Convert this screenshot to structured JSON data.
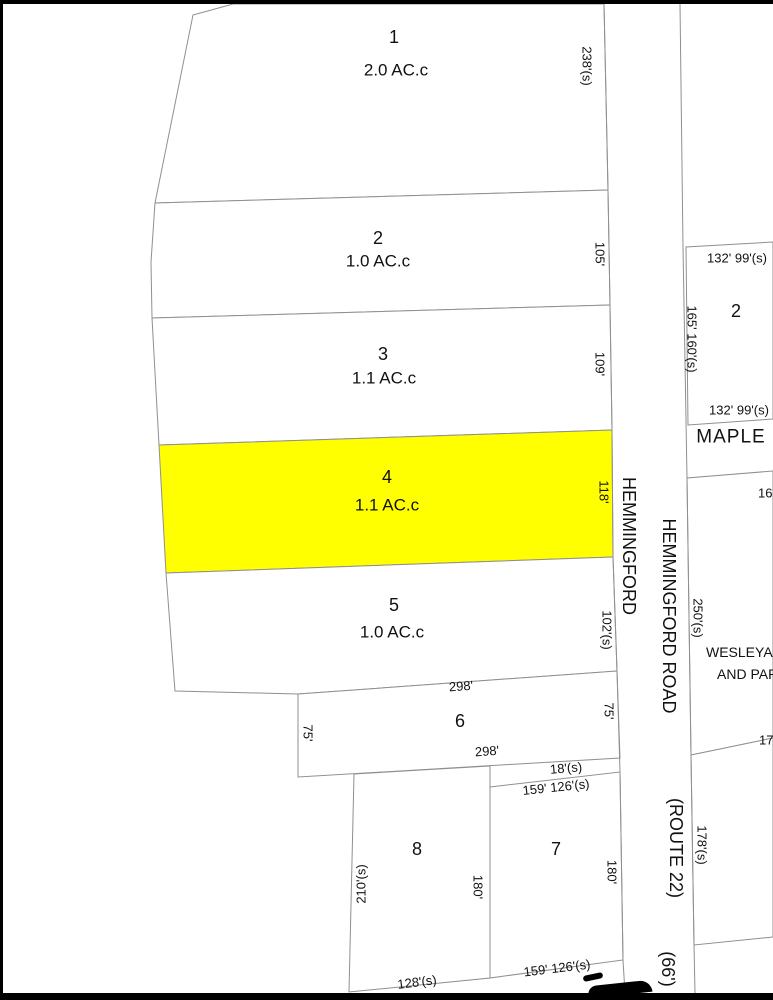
{
  "map": {
    "style": {
      "background": "#ffffff",
      "line_color": "#8f8f8f",
      "frame_color": "#000000",
      "text_color": "#111111",
      "highlight_fill": "#ffff00",
      "parcel_fill": "#ffffff"
    },
    "frame": [
      {
        "name": "frame-top",
        "x": 0,
        "y": 0,
        "w": 773,
        "h": 4
      },
      {
        "name": "frame-left",
        "x": 0,
        "y": 0,
        "w": 3,
        "h": 1000
      },
      {
        "name": "frame-bottom",
        "x": 0,
        "y": 993,
        "w": 773,
        "h": 7
      }
    ],
    "parcels": [
      {
        "name": "parcel-lot-1",
        "points": "233,4 604,4 608,190 155,203 193,15",
        "fill": "#ffffff"
      },
      {
        "name": "parcel-lot-2",
        "points": "155,203 608,190 610,305 152,318 151,262",
        "fill": "#ffffff"
      },
      {
        "name": "parcel-lot-3",
        "points": "152,318 610,305 612,430 159,445",
        "fill": "#ffffff"
      },
      {
        "name": "parcel-lot-4-highlighted",
        "points": "159,445 612,430 613,557 166,573",
        "fill": "#ffff00"
      },
      {
        "name": "parcel-lot-5",
        "points": "166,573 613,557 617,671 298,694 175,691",
        "fill": "#ffffff"
      },
      {
        "name": "parcel-lot-6",
        "points": "298,694 617,671 620,758 298,777",
        "fill": "#ffffff"
      },
      {
        "name": "parcel-lot-8",
        "points": "354,774 490,766 490,978 349,992",
        "fill": "#ffffff"
      },
      {
        "name": "parcel-lot-7",
        "points": "490,787 620,772 623,960 490,978",
        "fill": "#ffffff"
      },
      {
        "name": "parcel-maple-lot-2",
        "points": "773,242 686,247 688,425 773,419",
        "fill": "#ffffff"
      },
      {
        "name": "parcel-wesleyan",
        "points": "773,471 687,478 691,755 773,738",
        "fill": "#ffffff"
      },
      {
        "name": "parcel-south-of-wesleyan",
        "points": "773,738 691,755 694,945 773,937",
        "fill": "#ffffff"
      }
    ],
    "lines": [
      {
        "name": "road-west-edge",
        "points": "604,4 608,190 610,305 612,430 613,557 617,671 620,772 623,960 625,993"
      },
      {
        "name": "road-east-edge",
        "points": "680,4 683,247 687,478 691,755 694,945 695,993"
      }
    ],
    "labels": [
      {
        "n": "lot-1-number",
        "t": "1",
        "x": 394,
        "y": 37,
        "s": 18
      },
      {
        "n": "lot-1-area",
        "t": "2.0 AC.c",
        "x": 396,
        "y": 70,
        "s": 17
      },
      {
        "n": "dim-lot1-east",
        "t": "238'(s)",
        "x": 587,
        "y": 66,
        "r": 90,
        "s": 13
      },
      {
        "n": "lot-2-number",
        "t": "2",
        "x": 378,
        "y": 238,
        "s": 18
      },
      {
        "n": "lot-2-area",
        "t": "1.0 AC.c",
        "x": 378,
        "y": 261,
        "s": 17
      },
      {
        "n": "dim-lot2-east",
        "t": "105'",
        "x": 600,
        "y": 254,
        "r": 90,
        "s": 13
      },
      {
        "n": "lot-3-number",
        "t": "3",
        "x": 383,
        "y": 354,
        "s": 18
      },
      {
        "n": "lot-3-area",
        "t": "1.1 AC.c",
        "x": 384,
        "y": 378,
        "s": 17
      },
      {
        "n": "dim-lot3-east",
        "t": "109'",
        "x": 600,
        "y": 364,
        "r": 90,
        "s": 13
      },
      {
        "n": "lot-4-number",
        "t": "4",
        "x": 387,
        "y": 477,
        "s": 18
      },
      {
        "n": "lot-4-area",
        "t": "1.1 AC.c",
        "x": 387,
        "y": 505,
        "s": 17
      },
      {
        "n": "dim-lot4-east",
        "t": "118'",
        "x": 604,
        "y": 492,
        "r": 90,
        "s": 13
      },
      {
        "n": "lot-5-number",
        "t": "5",
        "x": 394,
        "y": 605,
        "s": 18
      },
      {
        "n": "lot-5-area",
        "t": "1.0 AC.c",
        "x": 392,
        "y": 632,
        "s": 17
      },
      {
        "n": "dim-lot5-east",
        "t": "102'(s)",
        "x": 607,
        "y": 630,
        "r": 90,
        "s": 13
      },
      {
        "n": "dim-lot6-north",
        "t": "298'",
        "x": 461,
        "y": 686,
        "r": -4,
        "s": 13
      },
      {
        "n": "lot-6-number",
        "t": "6",
        "x": 460,
        "y": 721,
        "s": 18
      },
      {
        "n": "dim-lot6-south",
        "t": "298'",
        "x": 487,
        "y": 751,
        "r": -4,
        "s": 13
      },
      {
        "n": "dim-lot6-west",
        "t": "75'",
        "x": 308,
        "y": 733,
        "r": 90,
        "s": 13
      },
      {
        "n": "dim-lot6-east",
        "t": "75'",
        "x": 609,
        "y": 711,
        "r": 90,
        "s": 13
      },
      {
        "n": "dim-18",
        "t": "18'(s)",
        "x": 566,
        "y": 768,
        "r": -5,
        "s": 13
      },
      {
        "n": "dim-lot7-north",
        "t": "159' 126'(s)",
        "x": 556,
        "y": 787,
        "r": -6,
        "s": 13
      },
      {
        "n": "lot-8-number",
        "t": "8",
        "x": 417,
        "y": 849,
        "s": 18
      },
      {
        "n": "dim-lot8-west",
        "t": "210'(s)",
        "x": 361,
        "y": 884,
        "r": -90,
        "s": 13
      },
      {
        "n": "dim-lot8-east",
        "t": "180'",
        "x": 478,
        "y": 887,
        "r": 90,
        "s": 13
      },
      {
        "n": "lot-7-number",
        "t": "7",
        "x": 556,
        "y": 849,
        "s": 18
      },
      {
        "n": "dim-lot7-east",
        "t": "180'",
        "x": 612,
        "y": 872,
        "r": 90,
        "s": 13
      },
      {
        "n": "dim-lot7-south",
        "t": "159' 126'(s)",
        "x": 557,
        "y": 968,
        "r": -7,
        "s": 13
      },
      {
        "n": "dim-lot8-south",
        "t": "128'(s)",
        "x": 417,
        "y": 982,
        "r": -7,
        "s": 13
      },
      {
        "n": "road-name-west",
        "t": "HEMMINGFORD",
        "x": 629,
        "y": 546,
        "r": 90,
        "s": 18
      },
      {
        "n": "road-name-east",
        "t": "HEMMINGFORD ROAD",
        "x": 669,
        "y": 616,
        "r": 90,
        "s": 18
      },
      {
        "n": "road-route",
        "t": "(ROUTE 22)",
        "x": 676,
        "y": 848,
        "r": 90,
        "s": 18
      },
      {
        "n": "road-width",
        "t": "(66')",
        "x": 668,
        "y": 969,
        "r": 90,
        "s": 18
      },
      {
        "n": "dim-maple2-north",
        "t": "132' 99'(s)",
        "x": 737,
        "y": 258,
        "s": 13
      },
      {
        "n": "maple-lot-2-number",
        "t": "2",
        "x": 736,
        "y": 311,
        "s": 18
      },
      {
        "n": "dim-maple2-west",
        "t": "165' 160'(s)",
        "x": 692,
        "y": 339,
        "r": 90,
        "s": 13
      },
      {
        "n": "dim-maple2-south",
        "t": "132' 99'(s)",
        "x": 739,
        "y": 410,
        "s": 13
      },
      {
        "n": "maple-street-name",
        "t": "MAPLE",
        "x": 731,
        "y": 437,
        "s": 19,
        "ls": 1
      },
      {
        "n": "dim-wesleyan-north",
        "t": "16",
        "x": 758,
        "y": 493,
        "s": 13,
        "a": "left"
      },
      {
        "n": "dim-wesleyan-west",
        "t": "250'(s)",
        "x": 698,
        "y": 618,
        "r": 90,
        "s": 13
      },
      {
        "n": "wesleyan-label-line1",
        "t": "WESLEYA",
        "x": 706,
        "y": 652,
        "s": 14,
        "a": "left"
      },
      {
        "n": "wesleyan-label-line2",
        "t": "AND PAR",
        "x": 717,
        "y": 674,
        "s": 14,
        "a": "left"
      },
      {
        "n": "dim-wesleyan-south",
        "t": "17",
        "x": 759,
        "y": 740,
        "s": 13,
        "a": "left"
      },
      {
        "n": "dim-south-parcel-west",
        "t": "178'(s)",
        "x": 702,
        "y": 845,
        "r": 90,
        "s": 13
      }
    ],
    "shapes": [
      {
        "n": "cutoff-glyph-fragment-bar",
        "x": 583,
        "y": 974,
        "w": 20,
        "h": 6,
        "r": -12,
        "br": "3px"
      },
      {
        "n": "cutoff-glyph-fragment-body",
        "x": 588,
        "y": 983,
        "w": 64,
        "h": 12,
        "r": -6,
        "br": "10px 14px 0 0"
      }
    ]
  }
}
